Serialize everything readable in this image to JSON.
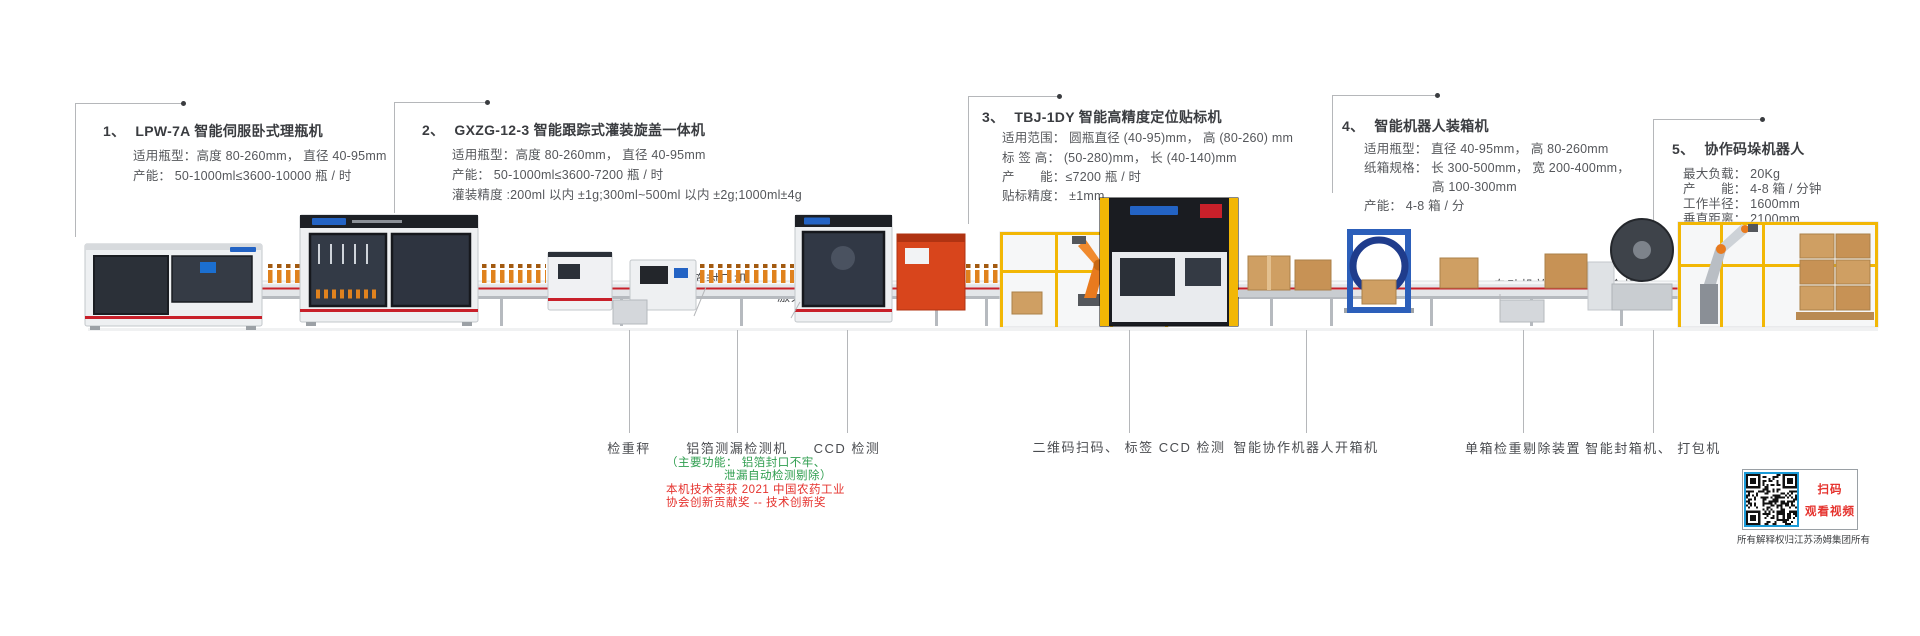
{
  "colors": {
    "text": "#4a4c50",
    "title": "#3a3c40",
    "green_note": "#2f9e4f",
    "red_note": "#e5322d",
    "leader_line": "#b5b7ba",
    "conveyor_stripe": "#c8202a",
    "machine_yellow": "#f2b705",
    "robot_orange": "#e87a1e",
    "accent_blue": "#2363c4",
    "qr_border_blue": "#1a9ad7"
  },
  "callouts": [
    {
      "num": "1、",
      "title": "LPW-7A 智能伺服卧式理瓶机",
      "specs": [
        "适用瓶型：高度 80-260mm，  直径 40-95mm",
        "产能：  50-1000ml≤3600-10000 瓶 / 时"
      ]
    },
    {
      "num": "2、",
      "title": "GXZG-12-3 智能跟踪式灌装旋盖一体机",
      "specs": [
        "适用瓶型：高度 80-260mm，  直径 40-95mm",
        "产能：  50-1000ml≤3600-7200 瓶 / 时",
        "灌装精度 :200ml 以内 ±1g;300ml~500ml 以内 ±2g;1000ml±4g"
      ]
    },
    {
      "num": "3、",
      "title": "TBJ-1DY 智能高精度定位贴标机",
      "specs": [
        "适用范围：  圆瓶直径 (40-95)mm，  高 (80-260) mm",
        "标 签 高：  (50-280)mm，  长 (40-140)mm",
        "产　　能：≤7200 瓶 / 时",
        "贴标精度：  ±1mm"
      ]
    },
    {
      "num": "4、",
      "title": "智能机器人装箱机",
      "specs": [
        "适用瓶型：  直径 40-95mm，  高 80-260mm",
        "纸箱规格：  长 300-500mm，  宽 200-400mm，",
        "高 100-300mm",
        "产能：  4-8 箱 / 分"
      ]
    },
    {
      "num": "5、",
      "title": "协作码垛机器人",
      "specs": [
        "最大负载：  20Kg",
        "产　　能：  4-8 箱 / 分钟",
        "工作半径：  1600mm",
        "垂直距离：  2100mm"
      ]
    }
  ],
  "inline_labels": {
    "foil_sealer": "铝箔封口机",
    "laser_coder": "激光喷码机",
    "auto_insert": "自动投放说明书、  合格证"
  },
  "stations": [
    {
      "label": "检重秤"
    },
    {
      "label": "铝箔测漏检测机"
    },
    {
      "label": "CCD 检测"
    },
    {
      "label": "二维码扫码、 标签 CCD 检测"
    },
    {
      "label": "智能协作机器人开箱机"
    },
    {
      "label": "单箱检重剔除装置"
    },
    {
      "label": "智能封箱机、 打包机"
    }
  ],
  "foil_note": {
    "line1": "（主要功能：  铝箔封口不牢、",
    "line2": "泄漏自动检测剔除）"
  },
  "award": {
    "line1": "本机技术荣获 2021 中国农药工业",
    "line2": "协会创新贡献奖 -- 技术创新奖"
  },
  "qr_panel": {
    "line1": "扫码",
    "line2": "观看视频",
    "caption": "所有解释权归江苏汤姆集团所有"
  }
}
